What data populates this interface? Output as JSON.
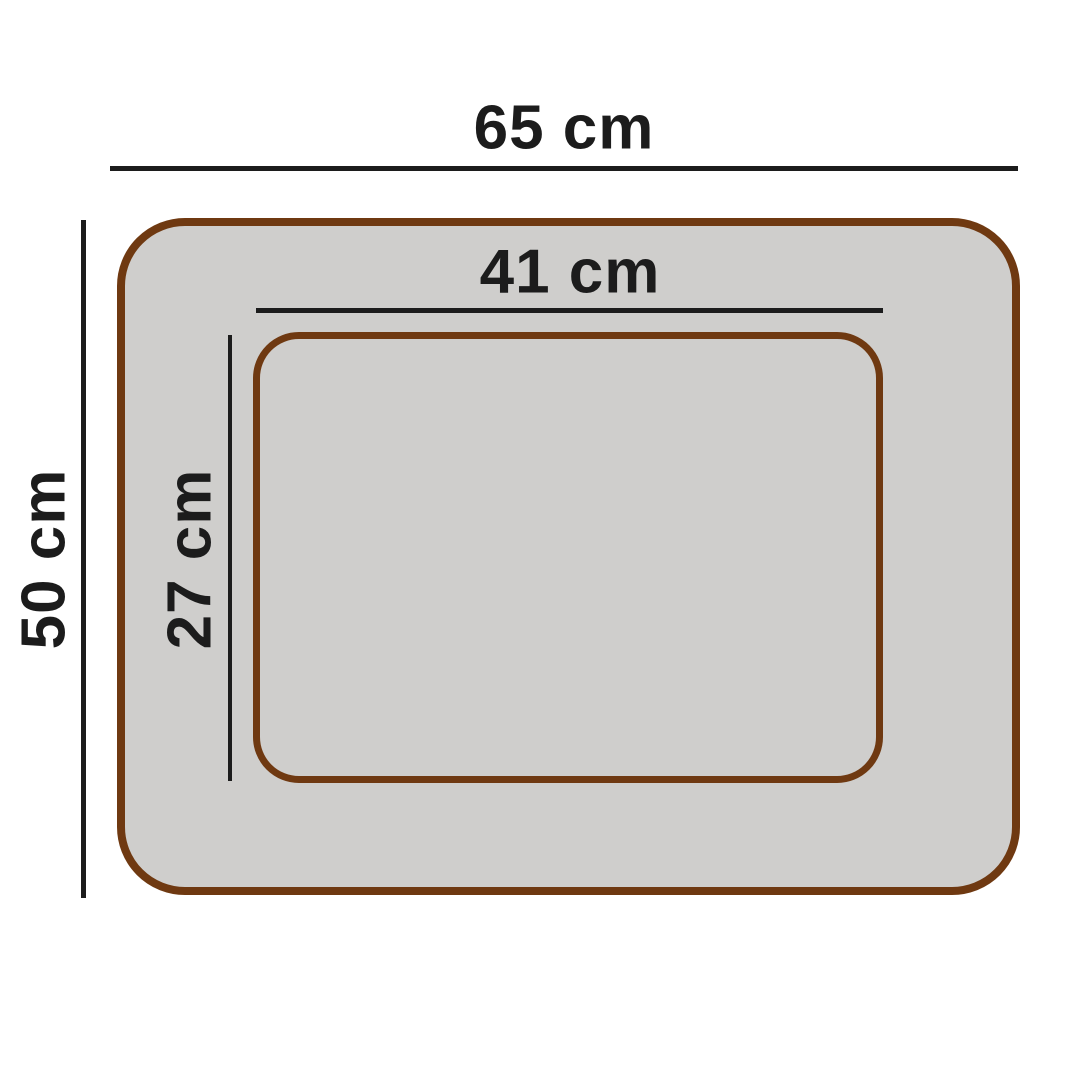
{
  "diagram": {
    "labels": {
      "outer_width": "65 cm",
      "outer_height": "50 cm",
      "inner_width": "41 cm",
      "inner_height": "27 cm"
    },
    "colors": {
      "border_brown": "#6F3911",
      "fill_gray": "#CFCECC",
      "line_black": "#1C1C1C",
      "background": "#FFFFFF"
    }
  }
}
